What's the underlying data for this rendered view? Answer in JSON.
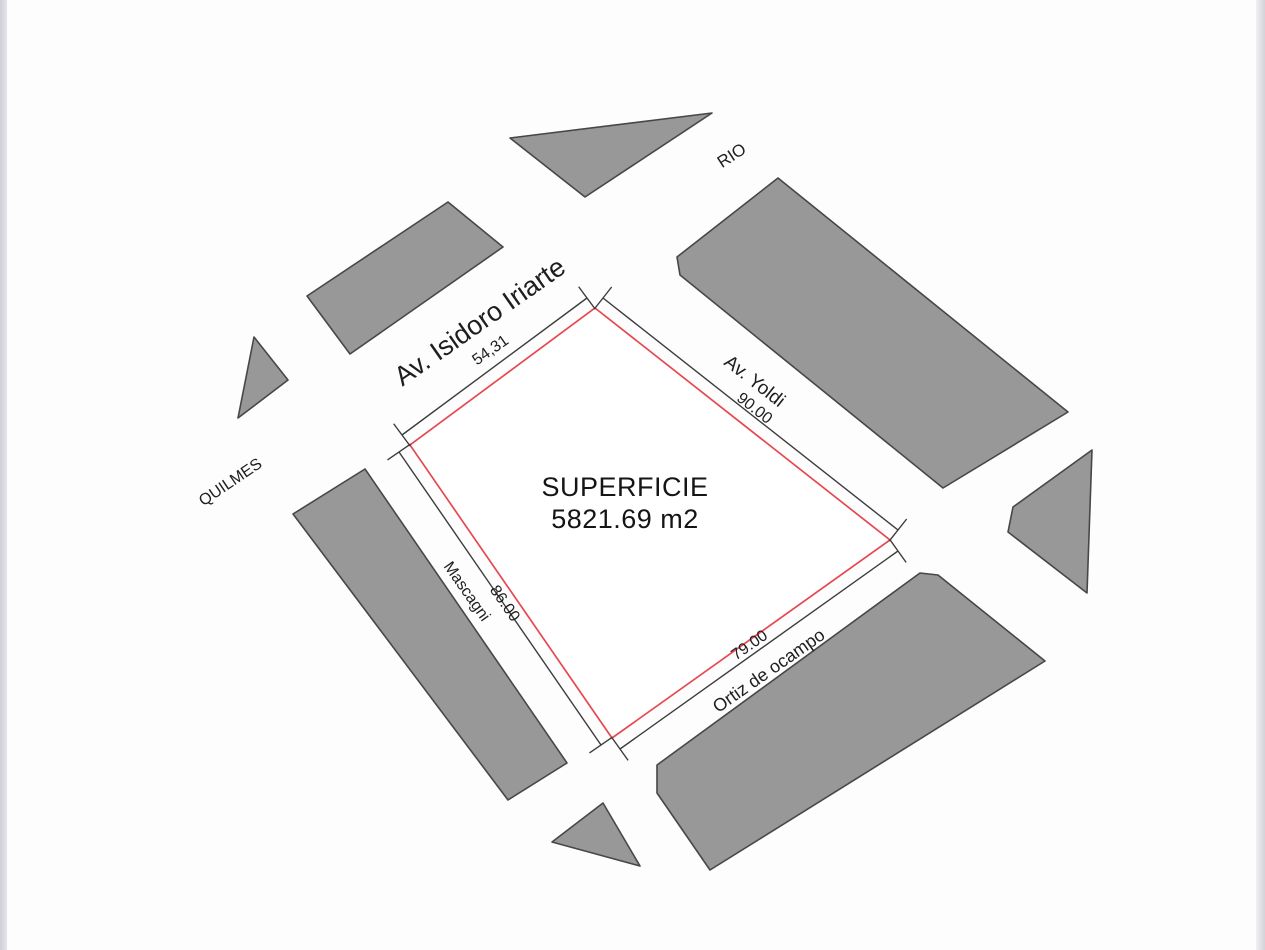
{
  "canvas": {
    "width": 1265,
    "height": 950,
    "background": "#fdfdfe",
    "edge_band_color": "#d8d8de",
    "block_fill": "#989898",
    "block_stroke": "#47474a",
    "dim_line_color": "#3c3c3e",
    "parcel_stroke": "#e5494f",
    "text_color": "#1e1e20"
  },
  "parcel": {
    "points": [
      [
        595,
        308
      ],
      [
        890,
        540
      ],
      [
        612,
        738
      ],
      [
        410,
        445
      ]
    ],
    "area_label": {
      "line1": "SUPERFICIE",
      "line2": "5821.69 m2",
      "x": 625,
      "y": 503
    }
  },
  "blocks": [
    {
      "name": "block-triangle-north",
      "points": [
        [
          510,
          138
        ],
        [
          712,
          113
        ],
        [
          585,
          197
        ]
      ]
    },
    {
      "name": "block-isidoro-north",
      "points": [
        [
          448,
          202
        ],
        [
          503,
          247
        ],
        [
          350,
          354
        ],
        [
          307,
          296
        ]
      ]
    },
    {
      "name": "block-triangle-west",
      "points": [
        [
          254,
          337
        ],
        [
          288,
          380
        ],
        [
          238,
          418
        ]
      ]
    },
    {
      "name": "block-yoldi-east",
      "points": [
        [
          778,
          178
        ],
        [
          1068,
          412
        ],
        [
          943,
          488
        ],
        [
          680,
          275
        ],
        [
          677,
          257
        ]
      ]
    },
    {
      "name": "block-mascagni-west",
      "points": [
        [
          365,
          469
        ],
        [
          567,
          763
        ],
        [
          508,
          800
        ],
        [
          293,
          514
        ]
      ]
    },
    {
      "name": "block-east-small",
      "points": [
        [
          1092,
          450
        ],
        [
          1087,
          593
        ],
        [
          1008,
          532
        ],
        [
          1013,
          507
        ]
      ]
    },
    {
      "name": "block-ortiz-south",
      "points": [
        [
          920,
          573
        ],
        [
          938,
          575
        ],
        [
          1045,
          661
        ],
        [
          710,
          870
        ],
        [
          657,
          793
        ],
        [
          657,
          765
        ]
      ]
    },
    {
      "name": "block-triangle-south",
      "points": [
        [
          603,
          803
        ],
        [
          552,
          842
        ],
        [
          640,
          866
        ]
      ]
    }
  ],
  "dimension_lines": [
    {
      "name": "dim-line-54-31",
      "from": [
        587,
        298
      ],
      "to": [
        402,
        435
      ]
    },
    {
      "name": "dim-line-90-00",
      "from": [
        603,
        298
      ],
      "to": [
        898,
        530
      ]
    },
    {
      "name": "dim-line-79-00",
      "from": [
        898,
        551
      ],
      "to": [
        620,
        749
      ]
    },
    {
      "name": "dim-line-86-00",
      "from": [
        399,
        452
      ],
      "to": [
        601,
        745
      ]
    }
  ],
  "labels": [
    {
      "name": "street-label-rio",
      "text": "RIO",
      "x": 732,
      "y": 156,
      "rotate": -33,
      "size": 17
    },
    {
      "name": "street-label-av-isidoro-iriarte",
      "text": "Av. Isidoro Iriarte",
      "x": 480,
      "y": 322,
      "rotate": -35,
      "size": 27
    },
    {
      "name": "dim-label-54-31",
      "text": "54,31",
      "x": 491,
      "y": 351,
      "rotate": -35,
      "size": 16
    },
    {
      "name": "street-label-av-yoldi",
      "text": "Av. Yoldi",
      "x": 754,
      "y": 382,
      "rotate": 38,
      "size": 19
    },
    {
      "name": "dim-label-90-00",
      "text": "90.00",
      "x": 754,
      "y": 409,
      "rotate": 38,
      "size": 16
    },
    {
      "name": "street-label-quilmes",
      "text": "QUILMES",
      "x": 231,
      "y": 483,
      "rotate": -34,
      "size": 16
    },
    {
      "name": "street-label-mascagni",
      "text": "Mascagni",
      "x": 466,
      "y": 592,
      "rotate": 55,
      "size": 16
    },
    {
      "name": "dim-label-86-00",
      "text": "86.00",
      "x": 504,
      "y": 604,
      "rotate": 55,
      "size": 16
    },
    {
      "name": "dim-label-79-00",
      "text": "79.00",
      "x": 750,
      "y": 646,
      "rotate": -35,
      "size": 16
    },
    {
      "name": "street-label-ortiz-de-ocampo",
      "text": "Ortiz de ocampo",
      "x": 769,
      "y": 671,
      "rotate": -35,
      "size": 18
    }
  ]
}
